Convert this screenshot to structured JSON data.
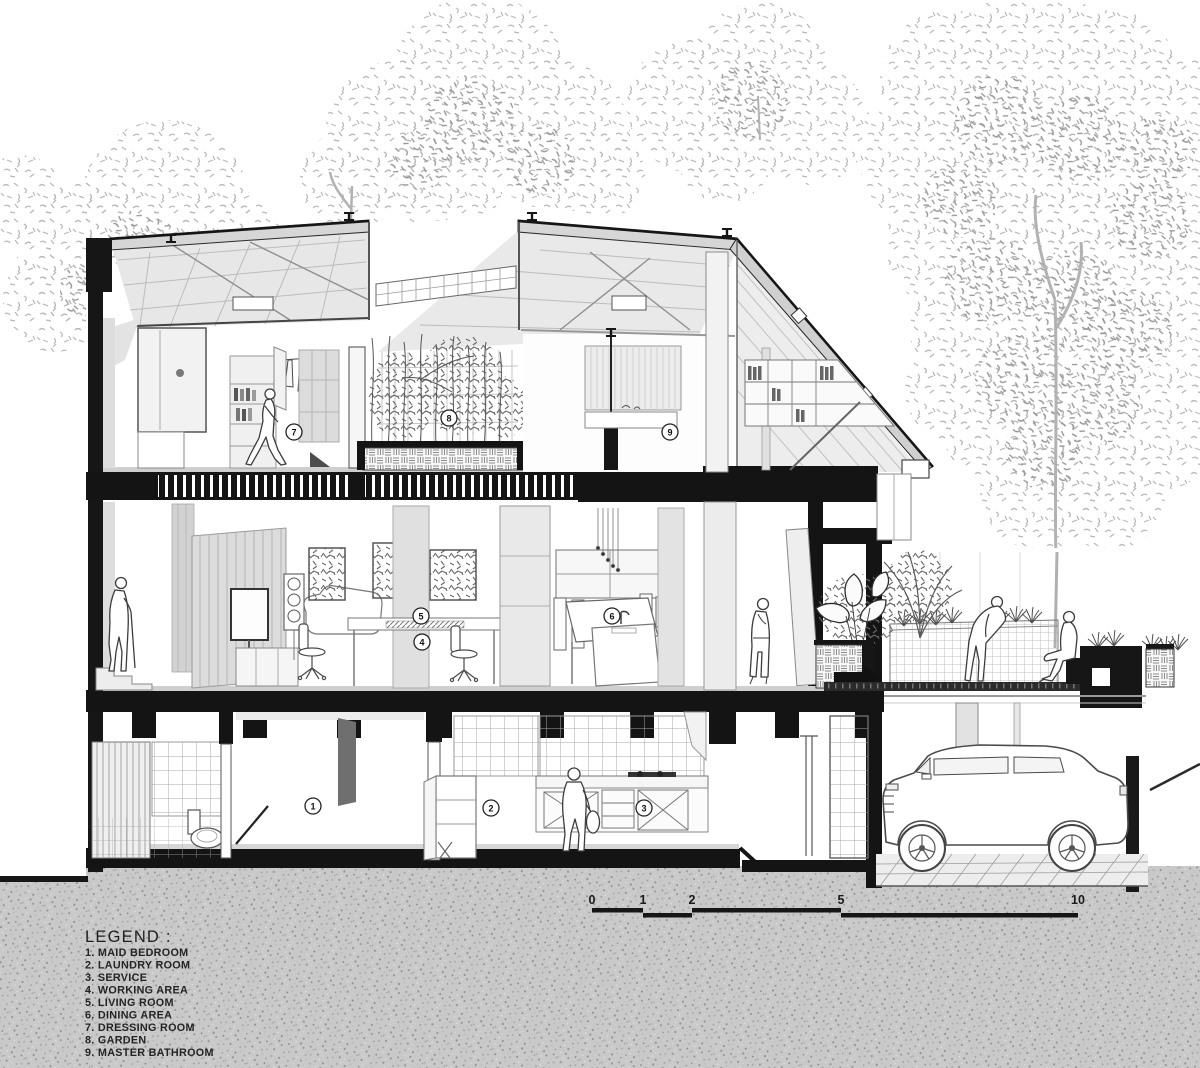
{
  "drawing": {
    "legend": {
      "title": "LEGEND :",
      "items": [
        "1. MAID BEDROOM",
        "2. LAUNDRY ROOM",
        "3. SERVICE",
        "4. WORKING AREA",
        "5. LIVING ROOM",
        "6. DINING AREA",
        "7. DRESSING ROOM",
        "8. GARDEN",
        "9. MASTER BATHROOM"
      ]
    },
    "scale_bar": {
      "ticks": [
        "0",
        "1",
        "2",
        "5",
        "10"
      ]
    },
    "room_markers": [
      "1",
      "2",
      "3",
      "4",
      "5",
      "6",
      "7",
      "8",
      "9"
    ],
    "colors": {
      "ink": "#161616",
      "paper": "#ffffff",
      "ground": "#c9c9c9",
      "roof_fill": "#d6d6d6",
      "foliage": "#b3b3b3"
    }
  }
}
